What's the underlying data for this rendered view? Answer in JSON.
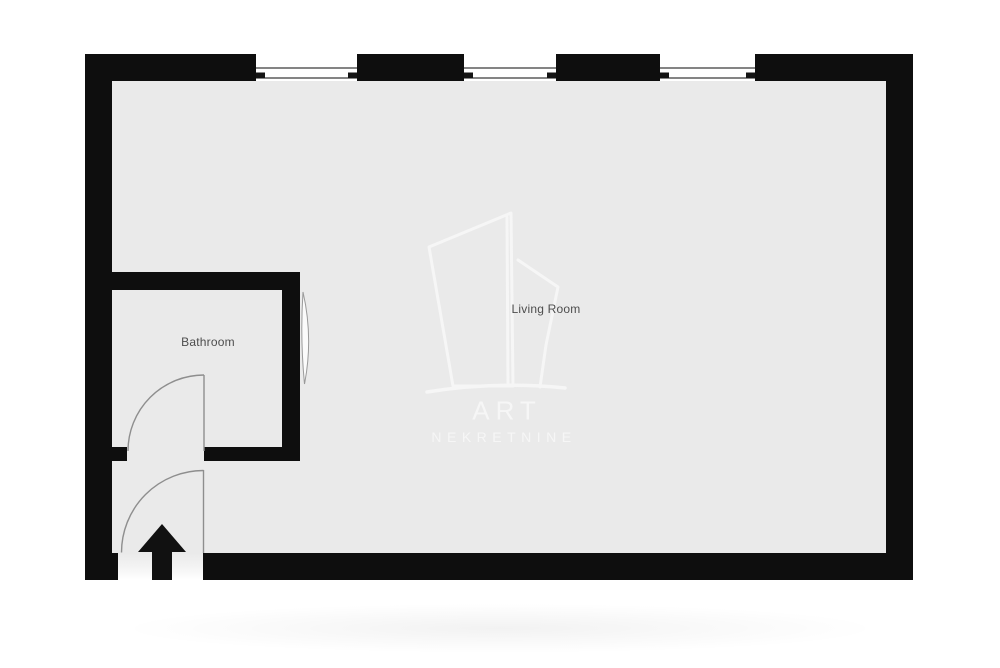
{
  "rooms": [
    {
      "name": "Living Room"
    },
    {
      "name": "Bathroom"
    }
  ],
  "watermark": {
    "brand": "ART",
    "subtitle": "NEKRETNINE"
  },
  "features": {
    "window_count": 3,
    "door_count": 2,
    "entrance_marker": "up-arrow"
  },
  "colors": {
    "wall": "#0e0e0e",
    "floor": "#eaeaea",
    "background": "#ffffff",
    "door_line": "#8e8e8e",
    "window_line": "#3a3a3a",
    "room_label": "#4d4d4d",
    "watermark": "#f6f6f6"
  }
}
